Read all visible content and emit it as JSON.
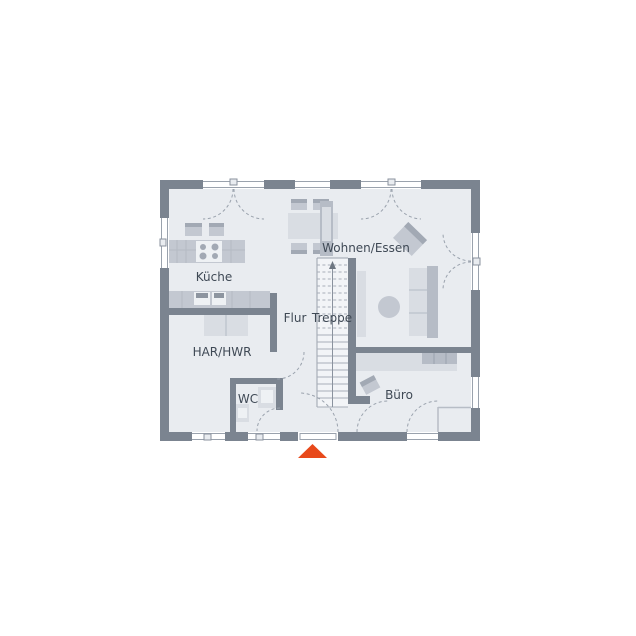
{
  "plan": {
    "type": "floor-plan",
    "floor_name": "Erdgeschoss"
  },
  "rooms": [
    {
      "id": "kueche",
      "label": "Küche"
    },
    {
      "id": "wohnen-essen",
      "label": "Wohnen/Essen"
    },
    {
      "id": "flur",
      "label": "Flur"
    },
    {
      "id": "treppe",
      "label": "Treppe"
    },
    {
      "id": "har-hwr",
      "label": "HAR/HWR"
    },
    {
      "id": "wc",
      "label": "WC"
    },
    {
      "id": "buero",
      "label": "Büro"
    }
  ],
  "marker": {
    "name": "entrance-marker",
    "shape": "triangle-up",
    "color": "#e8491a"
  },
  "colors": {
    "wall": "#7b8490",
    "floor": "#e9ecf0",
    "furniture_light": "#d9dde3",
    "furniture_medium": "#c3c8d1",
    "line": "#9aa2ad",
    "label": "#3f4955"
  }
}
